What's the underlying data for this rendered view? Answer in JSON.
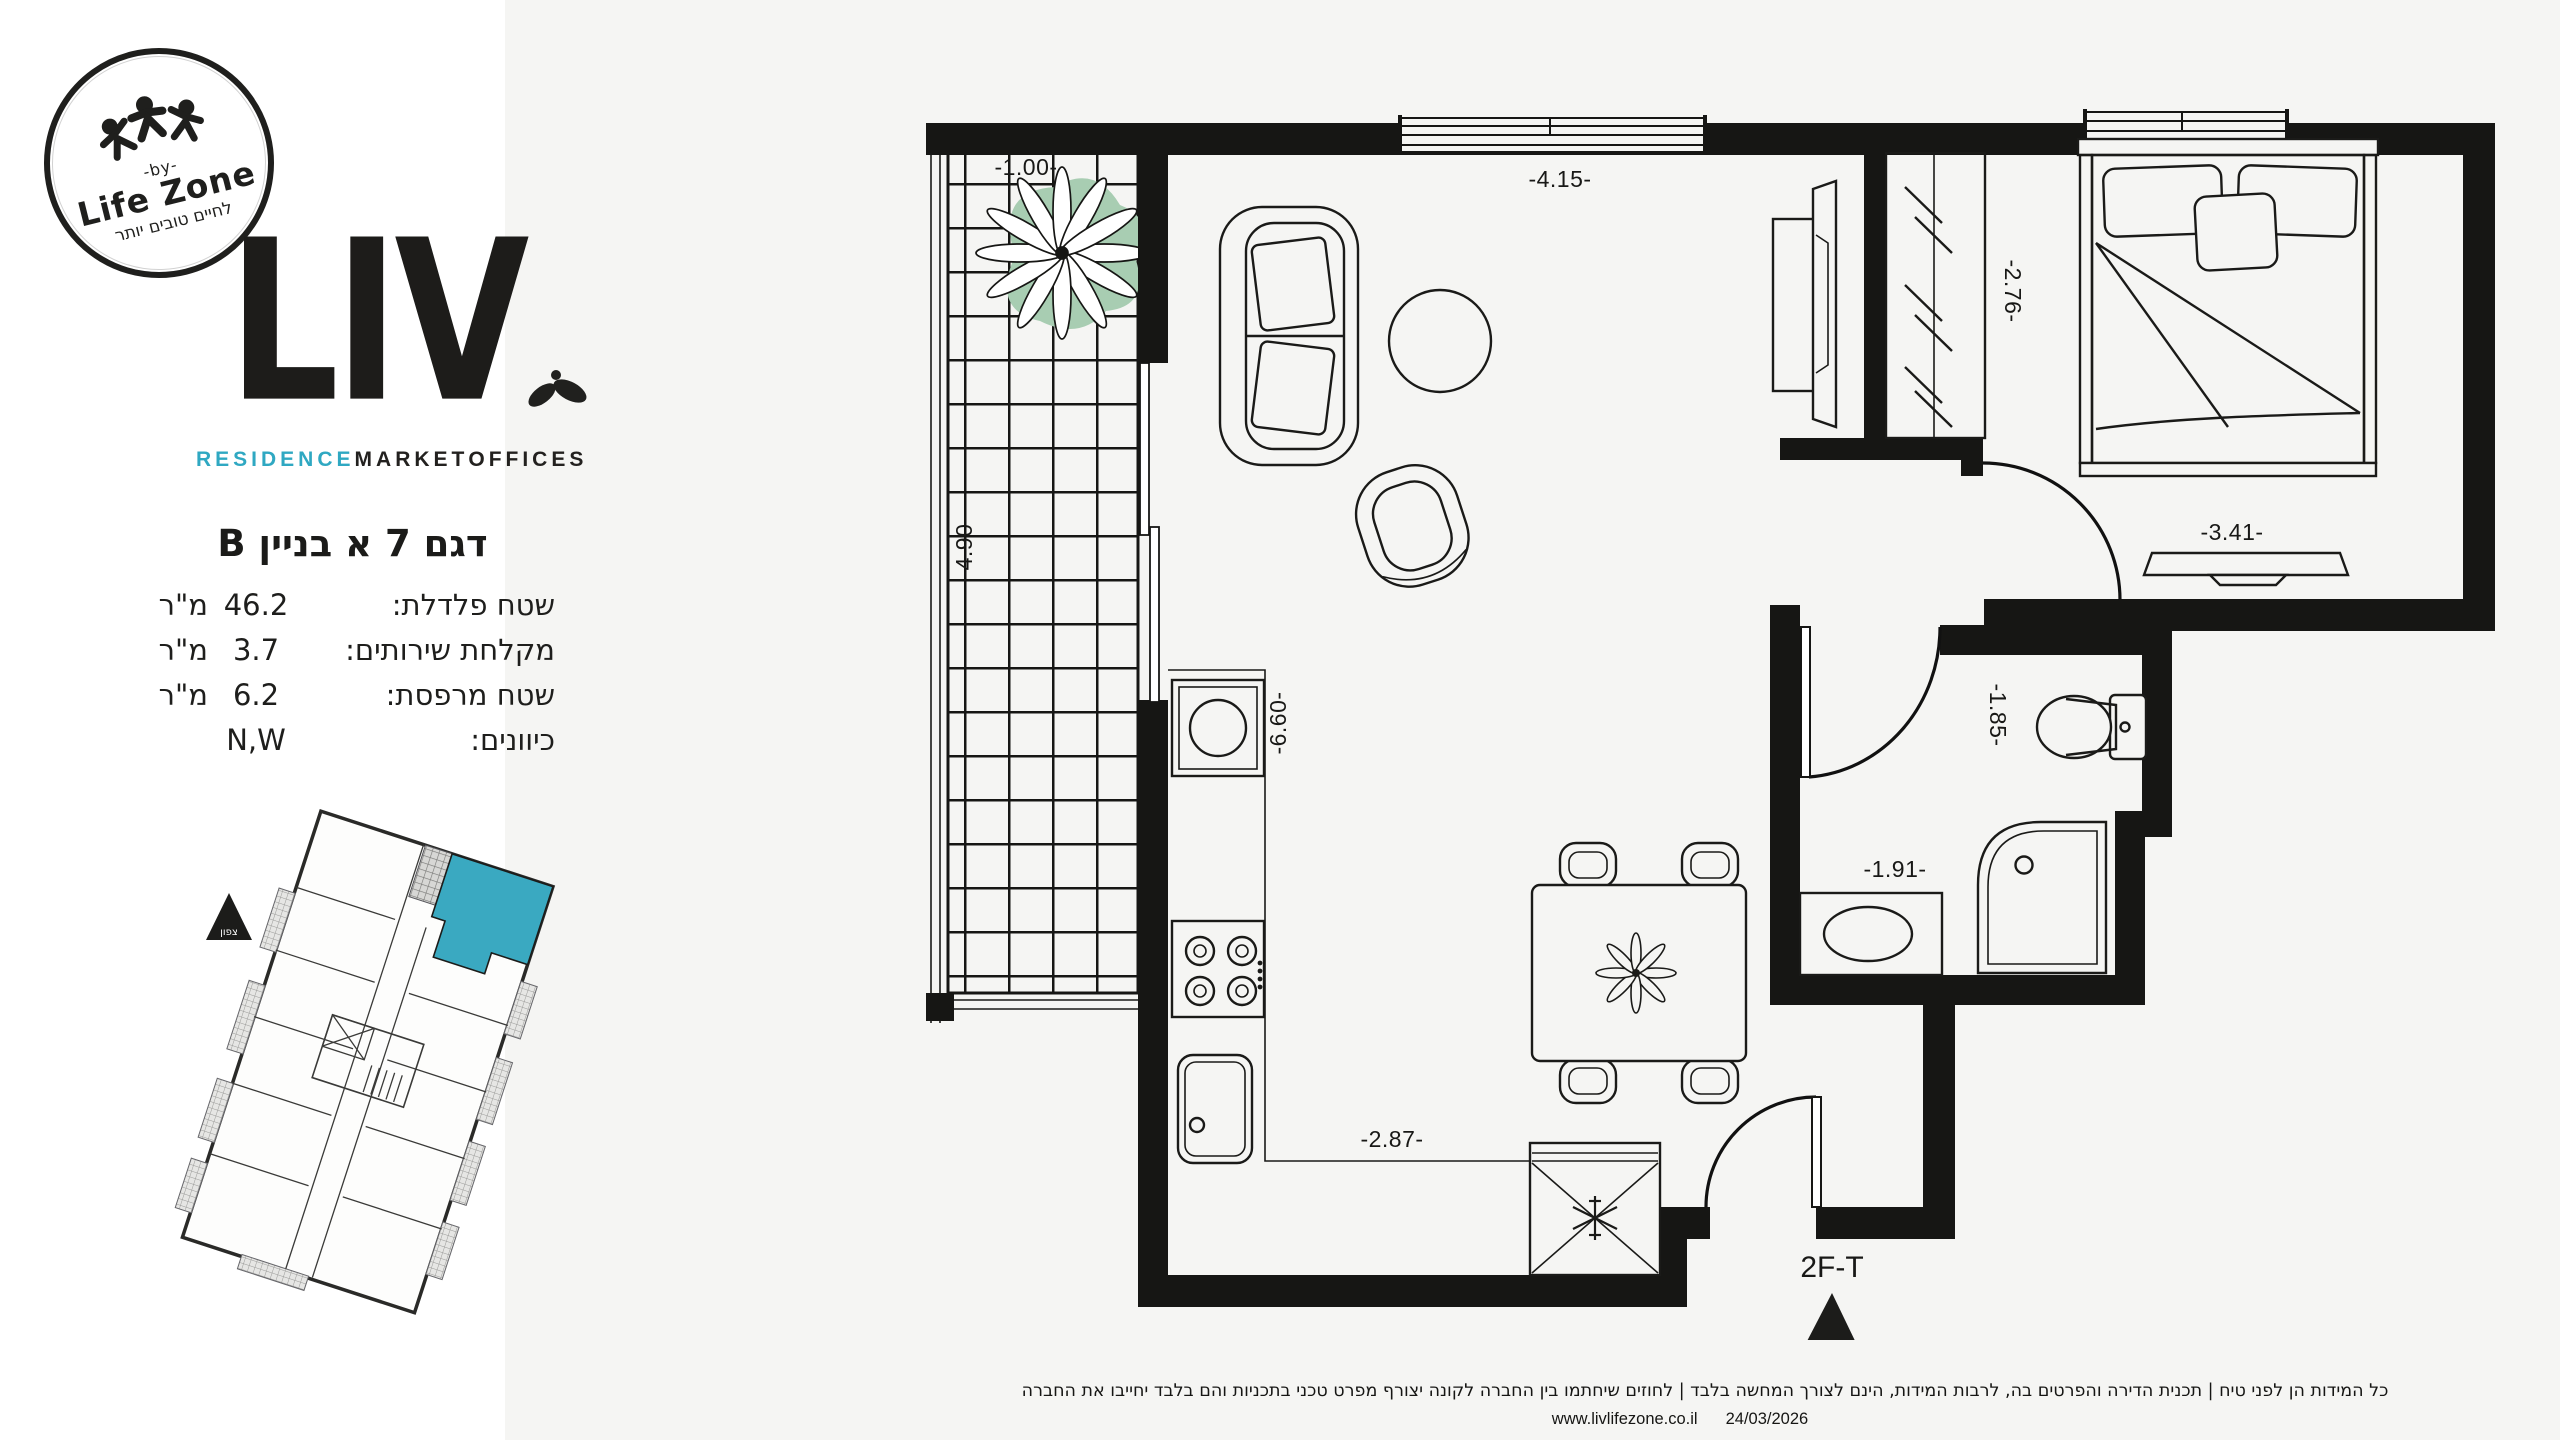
{
  "brand": {
    "stamp": {
      "by_label": "-by-",
      "name": "Life Zone",
      "tagline": "לחיים טובים יותר"
    },
    "logo_text": "LIV",
    "categories": [
      {
        "label": "RESIDENCE"
      },
      {
        "label": "MARKET"
      },
      {
        "label": "OFFICES"
      }
    ],
    "accent_color": "#2fa8c2"
  },
  "unit": {
    "title": "דגם 7 א בניין B",
    "specs": [
      {
        "label": "שטח פלדלת:",
        "value": "46.2",
        "unit": "מ\"ר"
      },
      {
        "label": "מקלחת שירותים:",
        "value": "3.7",
        "unit": "מ\"ר"
      },
      {
        "label": "שטח מרפסת:",
        "value": "6.2",
        "unit": "מ\"ר"
      },
      {
        "label": "כיוונים:",
        "value": "N,W",
        "unit": ""
      }
    ]
  },
  "keyplan": {
    "north_label": "צפון",
    "highlight_color": "#3aa9c1"
  },
  "plan": {
    "dims": {
      "balcony_w": "-1.00-",
      "living_w": "-4.15-",
      "balcony_h": "-4.90-",
      "closet": "-2.76-",
      "kitchen_h": "-6.60-",
      "bedroom_w": "-3.41-",
      "bath_a": "-1.85-",
      "bath_b": "-1.91-",
      "kitchen_w": "-2.87-",
      "entry": "2F-T"
    }
  },
  "footer": {
    "disclaimer": "כל המידות הן לפני טיח  |  תכנית הדירה והפרטים בה, לרבות המידות, הינם לצורך המחשה בלבד | לחוזים שיחתמו בין החברה לקונה יצורף מפרט טכני בתכניות והם בלבד יחייבו את החברה",
    "website": "www.livlifezone.co.il",
    "date": "24/03/2026"
  }
}
